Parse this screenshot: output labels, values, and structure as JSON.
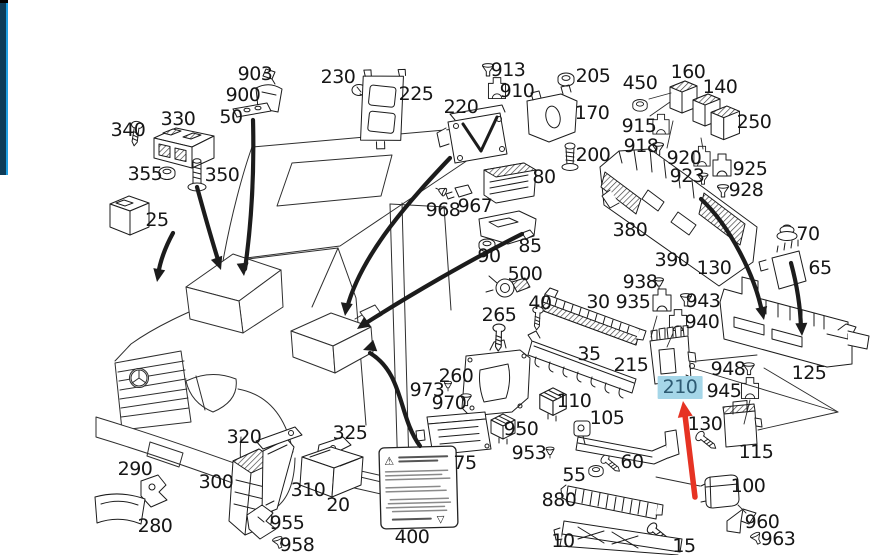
{
  "chrome": {
    "left_bar": {
      "fill": "#0d3b57",
      "edge": "#21a0e3",
      "notch": "#000000"
    }
  },
  "diagram": {
    "selected_part": "210",
    "colors": {
      "highlight_bg": "#a5d6e8",
      "highlight_text": "#2d5a72",
      "pointer_arrow": "#e63323",
      "line": "#1c1c1c"
    },
    "sticker": {
      "warning_glyph": "⚠",
      "bottom_glyph": "▽"
    },
    "labels": [
      {
        "text": "903",
        "x": 255,
        "y": 75
      },
      {
        "text": "900",
        "x": 243,
        "y": 96
      },
      {
        "text": "50",
        "x": 231,
        "y": 118
      },
      {
        "text": "330",
        "x": 178,
        "y": 120
      },
      {
        "text": "340",
        "x": 128,
        "y": 131
      },
      {
        "text": "355",
        "x": 145,
        "y": 175
      },
      {
        "text": "350",
        "x": 222,
        "y": 176
      },
      {
        "text": "25",
        "x": 157,
        "y": 221
      },
      {
        "text": "230",
        "x": 338,
        "y": 78
      },
      {
        "text": "225",
        "x": 416,
        "y": 95
      },
      {
        "text": "913",
        "x": 508,
        "y": 71
      },
      {
        "text": "910",
        "x": 517,
        "y": 92
      },
      {
        "text": "220",
        "x": 461,
        "y": 108
      },
      {
        "text": "205",
        "x": 593,
        "y": 77
      },
      {
        "text": "450",
        "x": 640,
        "y": 84
      },
      {
        "text": "160",
        "x": 688,
        "y": 73
      },
      {
        "text": "140",
        "x": 720,
        "y": 88
      },
      {
        "text": "250",
        "x": 754,
        "y": 123
      },
      {
        "text": "170",
        "x": 592,
        "y": 114
      },
      {
        "text": "915",
        "x": 639,
        "y": 127
      },
      {
        "text": "918",
        "x": 641,
        "y": 147
      },
      {
        "text": "200",
        "x": 593,
        "y": 156
      },
      {
        "text": "920",
        "x": 684,
        "y": 159
      },
      {
        "text": "923",
        "x": 687,
        "y": 177
      },
      {
        "text": "925",
        "x": 750,
        "y": 170
      },
      {
        "text": "928",
        "x": 746,
        "y": 191
      },
      {
        "text": "80",
        "x": 544,
        "y": 178
      },
      {
        "text": "968",
        "x": 443,
        "y": 211
      },
      {
        "text": "967",
        "x": 475,
        "y": 207
      },
      {
        "text": "85",
        "x": 530,
        "y": 247
      },
      {
        "text": "90",
        "x": 489,
        "y": 257
      },
      {
        "text": "500",
        "x": 525,
        "y": 275
      },
      {
        "text": "380",
        "x": 630,
        "y": 231
      },
      {
        "text": "390",
        "x": 672,
        "y": 261
      },
      {
        "text": "70",
        "x": 808,
        "y": 235
      },
      {
        "text": "65",
        "x": 820,
        "y": 269
      },
      {
        "text": "130",
        "x": 714,
        "y": 269
      },
      {
        "text": "938",
        "x": 640,
        "y": 283
      },
      {
        "text": "935",
        "x": 633,
        "y": 303
      },
      {
        "text": "943",
        "x": 703,
        "y": 302
      },
      {
        "text": "940",
        "x": 702,
        "y": 323
      },
      {
        "text": "30",
        "x": 598,
        "y": 303
      },
      {
        "text": "40",
        "x": 540,
        "y": 304
      },
      {
        "text": "265",
        "x": 499,
        "y": 316
      },
      {
        "text": "35",
        "x": 589,
        "y": 355
      },
      {
        "text": "215",
        "x": 631,
        "y": 366
      },
      {
        "text": "260",
        "x": 456,
        "y": 377
      },
      {
        "text": "973",
        "x": 427,
        "y": 391
      },
      {
        "text": "970",
        "x": 449,
        "y": 404
      },
      {
        "text": "110",
        "x": 574,
        "y": 402
      },
      {
        "text": "105",
        "x": 607,
        "y": 419
      },
      {
        "text": "950",
        "x": 521,
        "y": 430
      },
      {
        "text": "953",
        "x": 529,
        "y": 454
      },
      {
        "text": "55",
        "x": 574,
        "y": 476
      },
      {
        "text": "60",
        "x": 632,
        "y": 463
      },
      {
        "text": "210",
        "x": 680,
        "y": 388,
        "hl": true
      },
      {
        "text": "948",
        "x": 728,
        "y": 370
      },
      {
        "text": "945",
        "x": 724,
        "y": 392
      },
      {
        "text": "130",
        "x": 705,
        "y": 425
      },
      {
        "text": "115",
        "x": 756,
        "y": 453
      },
      {
        "text": "125",
        "x": 809,
        "y": 374
      },
      {
        "text": "100",
        "x": 748,
        "y": 487
      },
      {
        "text": "880",
        "x": 559,
        "y": 501
      },
      {
        "text": "10",
        "x": 563,
        "y": 542
      },
      {
        "text": "15",
        "x": 684,
        "y": 547
      },
      {
        "text": "960",
        "x": 762,
        "y": 523
      },
      {
        "text": "963",
        "x": 778,
        "y": 540
      },
      {
        "text": "290",
        "x": 135,
        "y": 470
      },
      {
        "text": "280",
        "x": 155,
        "y": 527
      },
      {
        "text": "320",
        "x": 244,
        "y": 438
      },
      {
        "text": "325",
        "x": 350,
        "y": 434
      },
      {
        "text": "300",
        "x": 216,
        "y": 483
      },
      {
        "text": "310",
        "x": 308,
        "y": 491
      },
      {
        "text": "20",
        "x": 338,
        "y": 506
      },
      {
        "text": "955",
        "x": 287,
        "y": 524
      },
      {
        "text": "958",
        "x": 297,
        "y": 546
      },
      {
        "text": "75",
        "x": 465,
        "y": 464
      },
      {
        "text": "400",
        "x": 412,
        "y": 538
      }
    ]
  }
}
